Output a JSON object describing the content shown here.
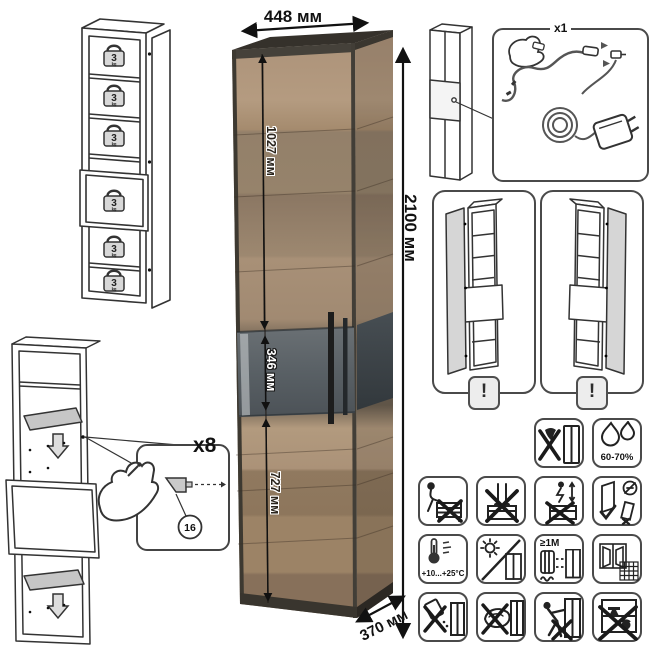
{
  "sheet": {
    "dimensions": {
      "width": "448 мм",
      "height": "2100 мм",
      "depth": "370 мм",
      "upper_section": "1027 мм",
      "middle_section": "346 мм",
      "lower_section": "727 мм"
    },
    "shelf_capacity": {
      "value": "3",
      "unit": "kg"
    },
    "hardware_callout": {
      "quantity": "x8",
      "part_number": "16"
    },
    "led_callout": {
      "quantity": "x1"
    },
    "door_options": {
      "left_hinge_warning": "!",
      "right_hinge_warning": "!"
    },
    "care": {
      "humidity": "60-70%",
      "temperature": "+10...+25°C",
      "radiator_distance": "≥1М",
      "icons": [
        "no-impact",
        "humidity-60-70",
        "no-sitting",
        "no-standing-on-top",
        "no-jumping",
        "door-adjustment-keep-upright",
        "temperature-range",
        "no-direct-sunlight",
        "radiator-distance",
        "room-ventilation",
        "no-spilled-liquids",
        "no-abrasive-cleaning",
        "no-pushing-leaning",
        "no-shelf-overloading"
      ]
    },
    "colors": {
      "wood": "#a58b6e",
      "graphite": "#3f3b34",
      "glass": "#5a6065",
      "line_art": "#333333"
    }
  }
}
